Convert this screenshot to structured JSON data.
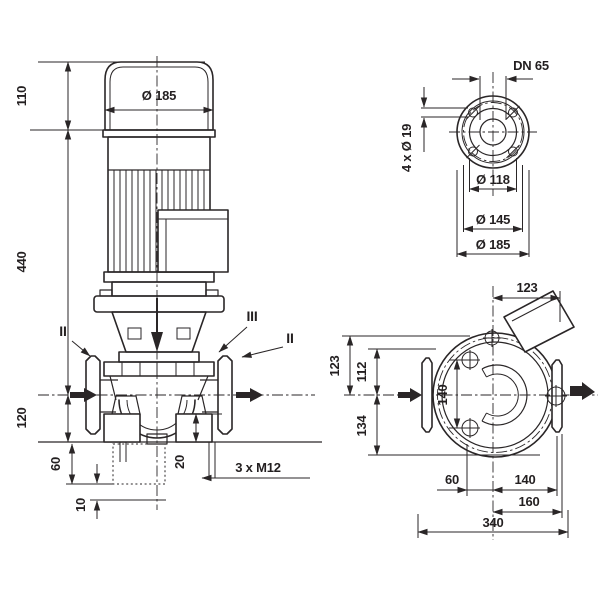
{
  "drawing": {
    "background_color": "#ffffff",
    "line_color": "#2a2627",
    "front_view": {
      "dim_motor_diameter": "Ø 185",
      "dim_height_top": "110",
      "dim_height_mid": "440",
      "dim_height_base": "120",
      "dim_base_depth": "60",
      "dim_base_offset": "10",
      "dim_foot_thickness": "20",
      "label_thread": "3 x M12",
      "section_label_left": "II",
      "section_label_mid": "III",
      "section_label_right": "II"
    },
    "flange_view": {
      "label_nominal_bore": "DN 65",
      "label_bolt_holes": "4 x Ø 19",
      "dim_raised_face": "Ø 118",
      "dim_bolt_circle": "Ø 145",
      "dim_outer_diameter": "Ø 185"
    },
    "plan_view": {
      "dim_top_offset": "123",
      "dim_left_outer": "123",
      "dim_left_inner": "112",
      "dim_left_lower": "134",
      "dim_port_distance": "140",
      "dim_bottom_left": "60",
      "dim_bottom_right": "140",
      "dim_bottom_flange": "160",
      "dim_overall_length": "340"
    }
  }
}
